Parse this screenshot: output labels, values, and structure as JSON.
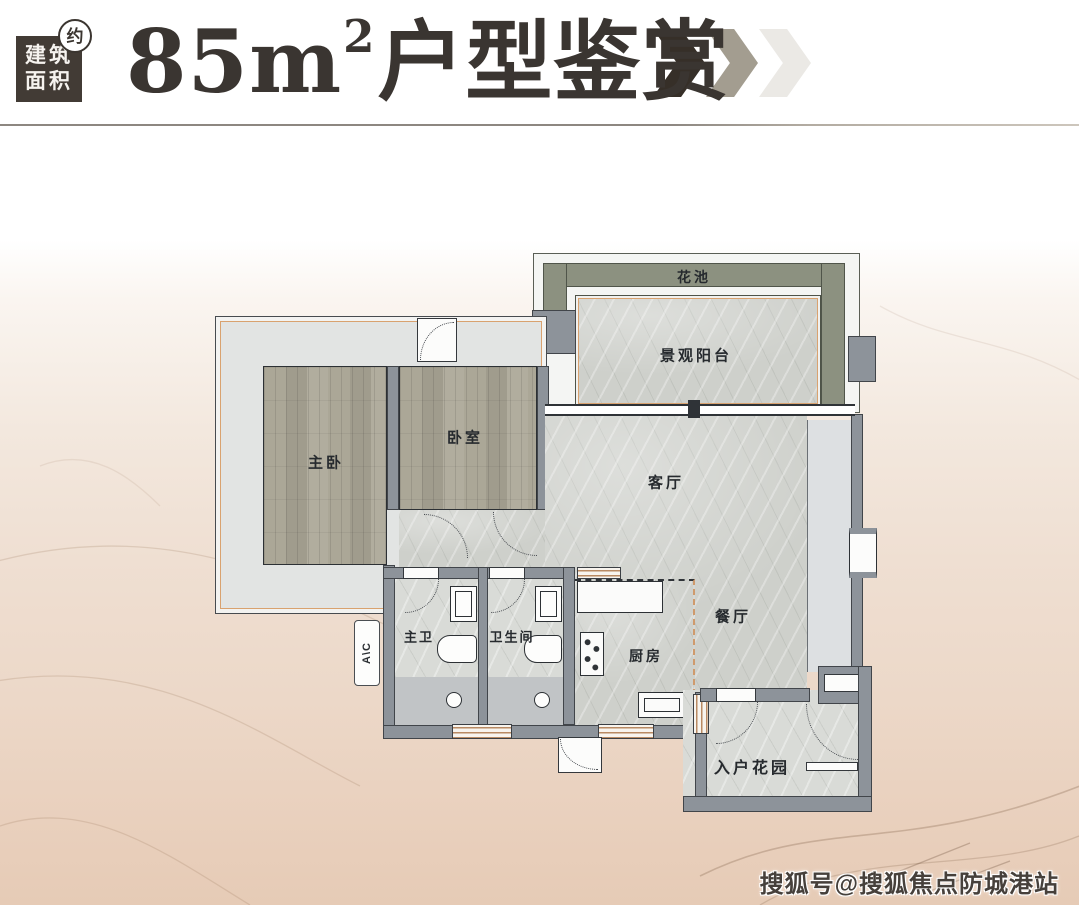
{
  "header": {
    "badge": {
      "line1": "建筑",
      "line2": "面积",
      "approx": "约"
    },
    "title": {
      "num": "85m",
      "sup": "2",
      "rest": "户型鉴赏"
    }
  },
  "plan": {
    "rooms": {
      "flower_bed": "花池",
      "view_balcony": "景观阳台",
      "master_bedroom": "主卧",
      "bedroom": "卧室",
      "living_room": "客厅",
      "dining_room": "餐厅",
      "master_bath": "主卫",
      "bathroom": "卫生间",
      "kitchen": "厨房",
      "entry_garden": "入户花园",
      "ac_label": "A\\C"
    }
  },
  "watermark": "搜狐号@搜狐焦点防城港站",
  "colors": {
    "title_ink": "#3a3531",
    "badge_bg": "#423b35",
    "chevron_dark": "#362f28",
    "chevron_mid": "#a39d90",
    "chevron_light": "#ebe9e5",
    "wall": "#8d939a",
    "wood": "#a7a395",
    "marble": "#ced0cb",
    "marble_light": "#d9dbd7",
    "terrace": "#e2e4e3",
    "flower": "#8c9180",
    "bay": "#dde0e2",
    "accent": "#d9a26f",
    "bath_lower": "#c1c4c6",
    "watermark_ink": "#46403b"
  }
}
